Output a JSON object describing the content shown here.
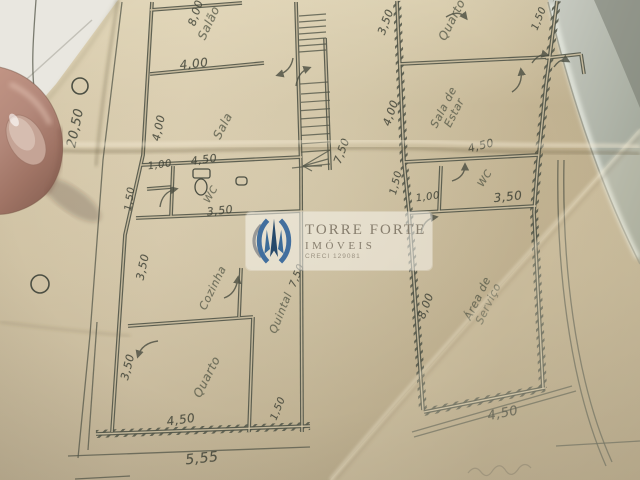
{
  "logo": {
    "brand": "TORRE FORTE",
    "subtitle": "IMÓVEIS",
    "creci": "CRECI 129081"
  },
  "colors": {
    "logo_blue": "#426f9e",
    "logo_navy": "#264a6b",
    "pencil": "#54574a",
    "paper": "#d0c3a4"
  },
  "plan": {
    "labels": [
      {
        "text": "20,50",
        "x": 76,
        "y": 128,
        "rot": -78,
        "fs": 13,
        "kind": "dimension"
      },
      {
        "text": "8,00",
        "x": 196,
        "y": 13,
        "rot": -72,
        "fs": 11,
        "kind": "dimension"
      },
      {
        "text": "Salão",
        "x": 209,
        "y": 23,
        "rot": -65,
        "fs": 12,
        "kind": "room"
      },
      {
        "text": "4,00",
        "x": 194,
        "y": 64,
        "rot": -6,
        "fs": 12,
        "kind": "dimension"
      },
      {
        "text": "4,00",
        "x": 159,
        "y": 128,
        "rot": -78,
        "fs": 11,
        "kind": "dimension"
      },
      {
        "text": "Sala",
        "x": 223,
        "y": 126,
        "rot": -63,
        "fs": 12,
        "kind": "room"
      },
      {
        "text": "1,00",
        "x": 160,
        "y": 166,
        "rot": -8,
        "fs": 10,
        "kind": "dimension"
      },
      {
        "text": "4,50",
        "x": 204,
        "y": 160,
        "rot": -7,
        "fs": 11,
        "kind": "dimension"
      },
      {
        "text": "1,50",
        "x": 131,
        "y": 199,
        "rot": -82,
        "fs": 10,
        "kind": "dimension"
      },
      {
        "text": "WC",
        "x": 212,
        "y": 195,
        "rot": -60,
        "fs": 10,
        "kind": "room"
      },
      {
        "text": "3,50",
        "x": 220,
        "y": 211,
        "rot": -6,
        "fs": 11,
        "kind": "dimension"
      },
      {
        "text": "3,50",
        "x": 143,
        "y": 267,
        "rot": -78,
        "fs": 11,
        "kind": "dimension"
      },
      {
        "text": "Cozinha",
        "x": 213,
        "y": 288,
        "rot": -64,
        "fs": 11,
        "kind": "room"
      },
      {
        "text": "Quintal",
        "x": 281,
        "y": 313,
        "rot": -68,
        "fs": 11,
        "kind": "room"
      },
      {
        "text": "7,50",
        "x": 298,
        "y": 276,
        "rot": -68,
        "fs": 10,
        "kind": "dimension"
      },
      {
        "text": "3,50",
        "x": 128,
        "y": 367,
        "rot": -76,
        "fs": 11,
        "kind": "dimension"
      },
      {
        "text": "Quarto",
        "x": 207,
        "y": 377,
        "rot": -63,
        "fs": 12,
        "kind": "room"
      },
      {
        "text": "4,50",
        "x": 181,
        "y": 420,
        "rot": -8,
        "fs": 12,
        "kind": "dimension"
      },
      {
        "text": "1,50",
        "x": 279,
        "y": 409,
        "rot": -68,
        "fs": 10,
        "kind": "dimension"
      },
      {
        "text": "5,55",
        "x": 202,
        "y": 459,
        "rot": -6,
        "fs": 14,
        "kind": "dimension"
      },
      {
        "text": "7,50",
        "x": 342,
        "y": 151,
        "rot": -70,
        "fs": 11,
        "kind": "dimension"
      },
      {
        "text": "4,00",
        "x": 391,
        "y": 113,
        "rot": -71,
        "fs": 11,
        "kind": "dimension"
      },
      {
        "text": "3,50",
        "x": 386,
        "y": 22,
        "rot": -70,
        "fs": 11,
        "kind": "dimension"
      },
      {
        "text": "Quarto",
        "x": 452,
        "y": 20,
        "rot": -63,
        "fs": 12,
        "kind": "room"
      },
      {
        "text": "1,50",
        "x": 540,
        "y": 19,
        "rot": -68,
        "fs": 10,
        "kind": "dimension"
      },
      {
        "text": "Sala de\nEstar",
        "x": 449,
        "y": 110,
        "rot": -63,
        "fs": 11,
        "kind": "room"
      },
      {
        "text": "4,50",
        "x": 481,
        "y": 146,
        "rot": -14,
        "fs": 11,
        "kind": "dimension"
      },
      {
        "text": "1,50",
        "x": 397,
        "y": 183,
        "rot": -76,
        "fs": 10,
        "kind": "dimension"
      },
      {
        "text": "1,00",
        "x": 428,
        "y": 198,
        "rot": -8,
        "fs": 10,
        "kind": "dimension"
      },
      {
        "text": "WC",
        "x": 486,
        "y": 179,
        "rot": -58,
        "fs": 10,
        "kind": "room"
      },
      {
        "text": "3,50",
        "x": 508,
        "y": 197,
        "rot": -6,
        "fs": 12,
        "kind": "dimension"
      },
      {
        "text": "8,00",
        "x": 426,
        "y": 306,
        "rot": -70,
        "fs": 11,
        "kind": "dimension"
      },
      {
        "text": "Área de\nServiço",
        "x": 483,
        "y": 301,
        "rot": -64,
        "fs": 11,
        "kind": "room"
      },
      {
        "text": "4,50",
        "x": 503,
        "y": 414,
        "rot": -11,
        "fs": 13,
        "kind": "dimension"
      }
    ]
  }
}
